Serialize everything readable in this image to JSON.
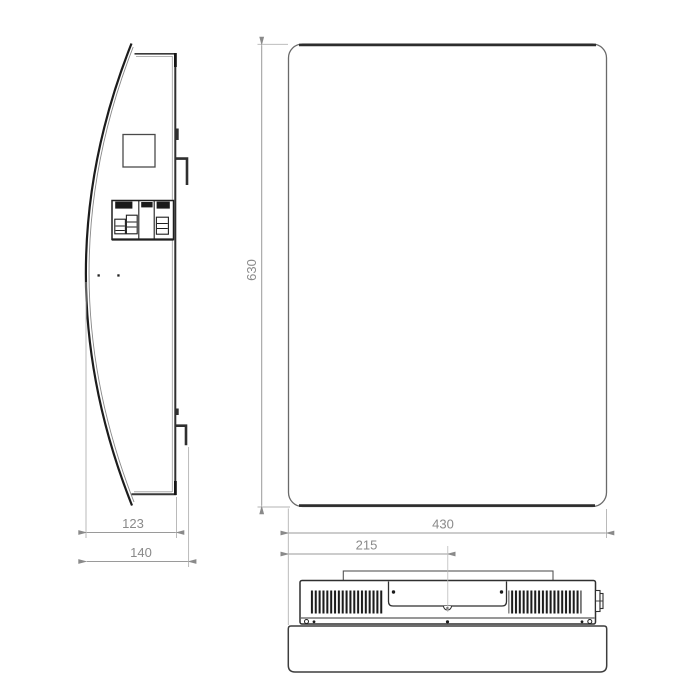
{
  "drawing": {
    "type": "technical-orthographic-drawing",
    "dimensions": {
      "front_height": "630",
      "front_width": "430",
      "bottom_center_offset": "215",
      "side_depth_inner": "123",
      "side_depth_total": "140"
    },
    "colors": {
      "object_line": "#2f2f2f",
      "thin_line": "#6a6a6a",
      "dim_line": "#9a9a9a",
      "dim_text": "#8a8a8a",
      "background": "#ffffff"
    }
  }
}
